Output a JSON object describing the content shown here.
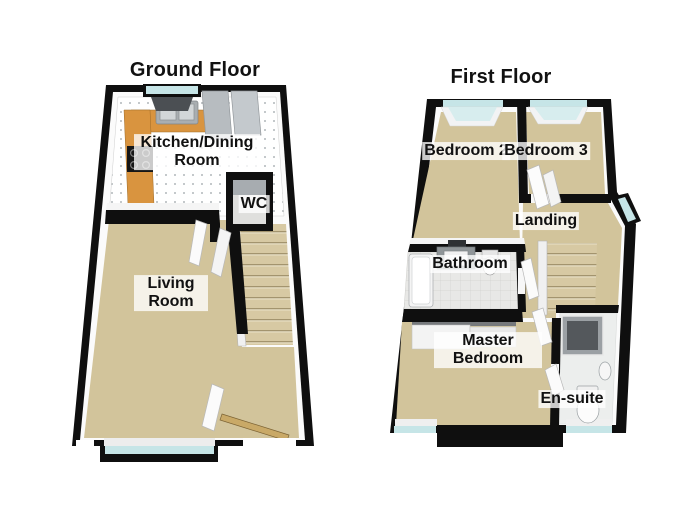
{
  "ground_floor": {
    "title": "Ground Floor",
    "rooms": [
      {
        "label": "Kitchen/Dining Room"
      },
      {
        "label": "WC"
      },
      {
        "label": "Living Room"
      }
    ],
    "fixtures": [
      "kitchen-counter",
      "kitchen-sink",
      "hob",
      "tall-units",
      "kitchen-window",
      "staircase",
      "bay-window",
      "front-door"
    ]
  },
  "first_floor": {
    "title": "First Floor",
    "rooms": [
      {
        "label": "Bedroom 2"
      },
      {
        "label": "Bedroom 3"
      },
      {
        "label": "Landing"
      },
      {
        "label": "Bathroom"
      },
      {
        "label": "Master Bedroom"
      },
      {
        "label": "En-suite"
      }
    ],
    "fixtures": [
      "bathtub",
      "wash-basin",
      "toilet",
      "shower-cubicle",
      "wardrobe",
      "staircase",
      "bedroom-windows",
      "landing-window"
    ]
  },
  "colors": {
    "wall": "#0f0f0f",
    "wall_top": "#fbfbfb",
    "carpet": "#d2c49b",
    "kitchen_counter": "#d9943f",
    "window_glass": "#c6e5e7",
    "bathroom_tile": "#e8e8e6",
    "stair_tread": "#d7c9a3",
    "label_background": "rgba(255,255,255,0.75)",
    "label_text": "#111111"
  }
}
